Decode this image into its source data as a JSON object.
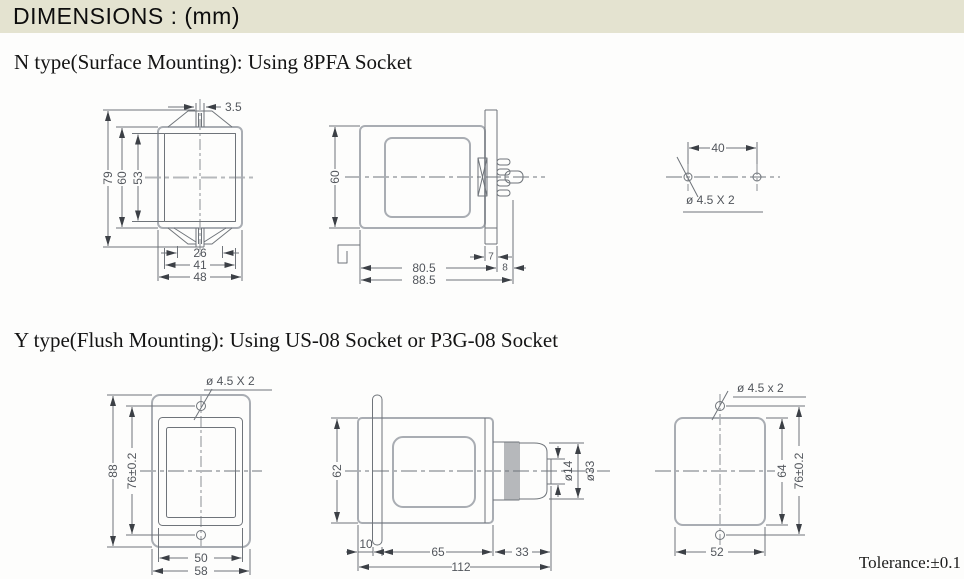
{
  "title_bar": {
    "title": "DIMENSIONS : (mm)",
    "bg_color": "#e4e3d0"
  },
  "sections": {
    "n_type": {
      "heading": "N type(Surface Mounting): Using 8PFA Socket"
    },
    "y_type": {
      "heading": "Y type(Flush Mounting): Using US-08 Socket or P3G-08 Socket"
    }
  },
  "tolerance_note": "Tolerance:±0.1",
  "colors": {
    "outline_gray": "#a9adb3",
    "line_gray": "#6f747a",
    "centerline_gray": "#b6b9bc"
  },
  "drawings": {
    "n_front": {
      "notch_width": "3.5",
      "overall_height": "79",
      "body_height": "60",
      "window_height": "53",
      "slot_span": "26",
      "tab_span": "41",
      "body_width": "48"
    },
    "n_side": {
      "body_height": "60",
      "flange_thickness": "7",
      "body_depth": "80.5",
      "pin_length": "8",
      "overall_depth": "88.5"
    },
    "n_holes": {
      "hole_pitch": "40",
      "hole_spec": "ø 4.5 X 2"
    },
    "y_front": {
      "hole_spec": "ø 4.5 X 2",
      "overall_height": "88",
      "hole_pitch": "76±0.2",
      "window_width": "50",
      "overall_width": "58"
    },
    "y_side": {
      "body_height": "62",
      "flange_offset": "10",
      "body_depth": "65",
      "socket_depth": "33",
      "overall_depth": "112",
      "shaft_dia": "ø14",
      "knob_dia": "ø33"
    },
    "y_rear": {
      "hole_spec": "ø 4.5 x 2",
      "cutout_height": "64",
      "hole_pitch": "76±0.2",
      "cutout_width": "52"
    }
  }
}
